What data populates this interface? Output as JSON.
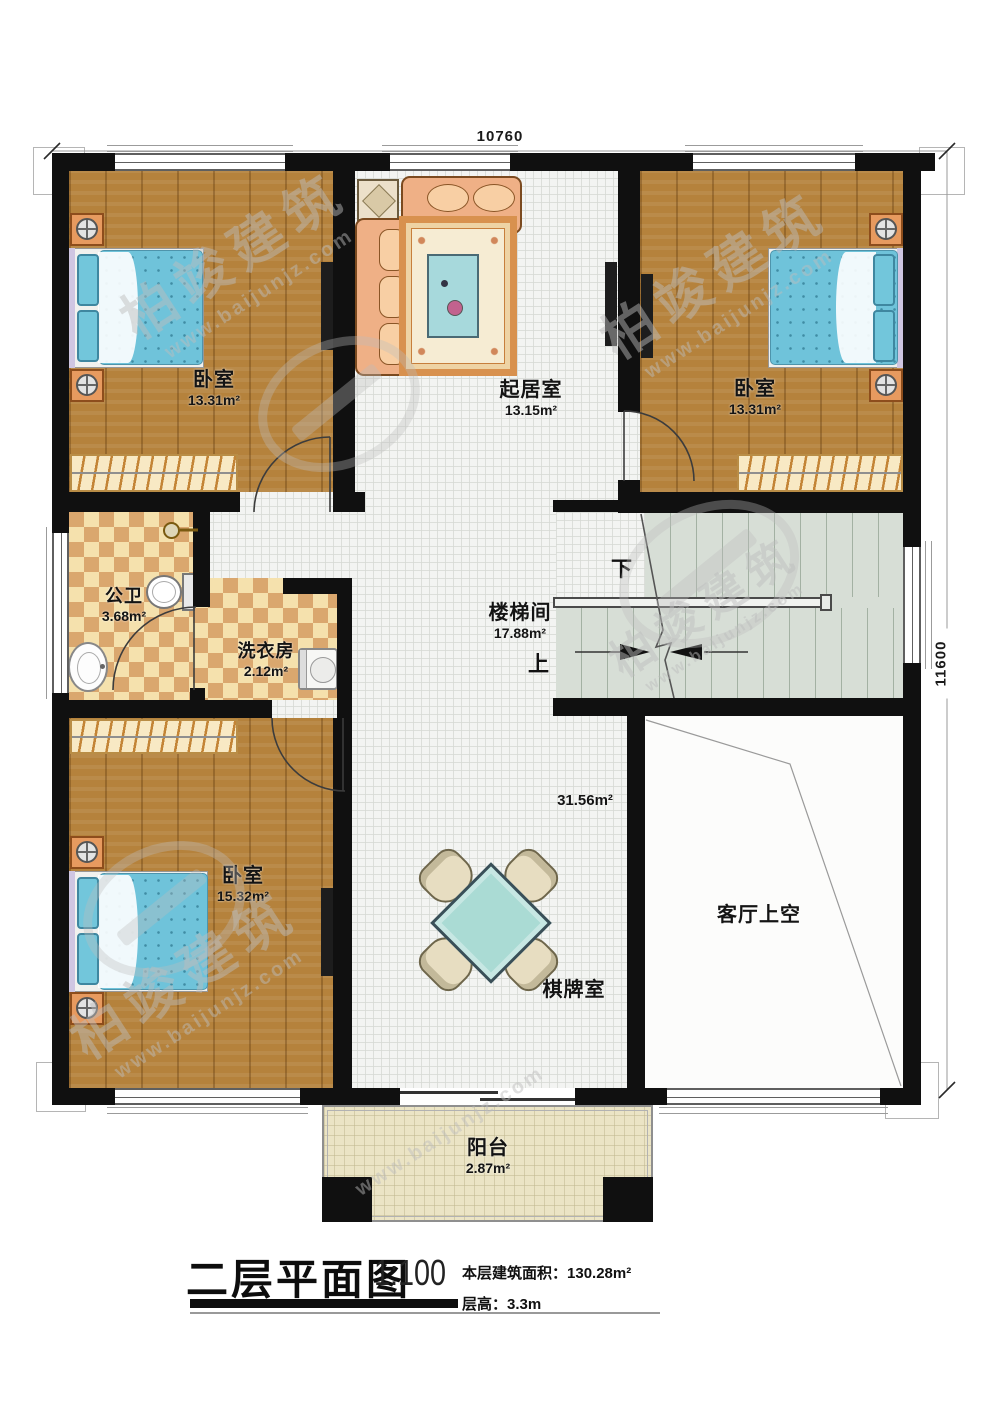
{
  "watermark": {
    "brand": "柏竣建筑",
    "url": "www.baijunjz.com"
  },
  "plan": {
    "dims": {
      "width": "10760",
      "height": "11600"
    },
    "rooms": {
      "bedroom_tl": {
        "name": "卧室",
        "area": "13.31m²"
      },
      "living": {
        "name": "起居室",
        "area": "13.15m²"
      },
      "bedroom_tr": {
        "name": "卧室",
        "area": "13.31m²"
      },
      "bath": {
        "name": "公卫",
        "area": "3.68m²"
      },
      "laundry": {
        "name": "洗衣房",
        "area": "2.12m²"
      },
      "stairwell": {
        "name": "楼梯间",
        "area": "17.88m²",
        "up": "上",
        "down": "下"
      },
      "bedroom_bl": {
        "name": "卧室",
        "area": "15.32m²"
      },
      "game_room": {
        "name": "棋牌室",
        "area": "31.56m²"
      },
      "living_void": {
        "name": "客厅上空"
      },
      "balcony": {
        "name": "阳台",
        "area": "2.87m²"
      }
    },
    "colors": {
      "wall": "#101010",
      "wood_floor": "#b5823c",
      "tile_light": "#f5e1ad",
      "tile_dark": "#daa76e",
      "bed": "#6fc3da",
      "stair": "#d7ded6",
      "balcony": "#ebe4c5",
      "game_table": "#aadbd4",
      "sofa": "#efb086"
    }
  },
  "title_block": {
    "title": "二层平面图",
    "scale": "1:100",
    "floor_area_label": "本层建筑面积：",
    "floor_area_value": "130.28m²",
    "floor_height_label": "层高：",
    "floor_height_value": "3.3m"
  }
}
